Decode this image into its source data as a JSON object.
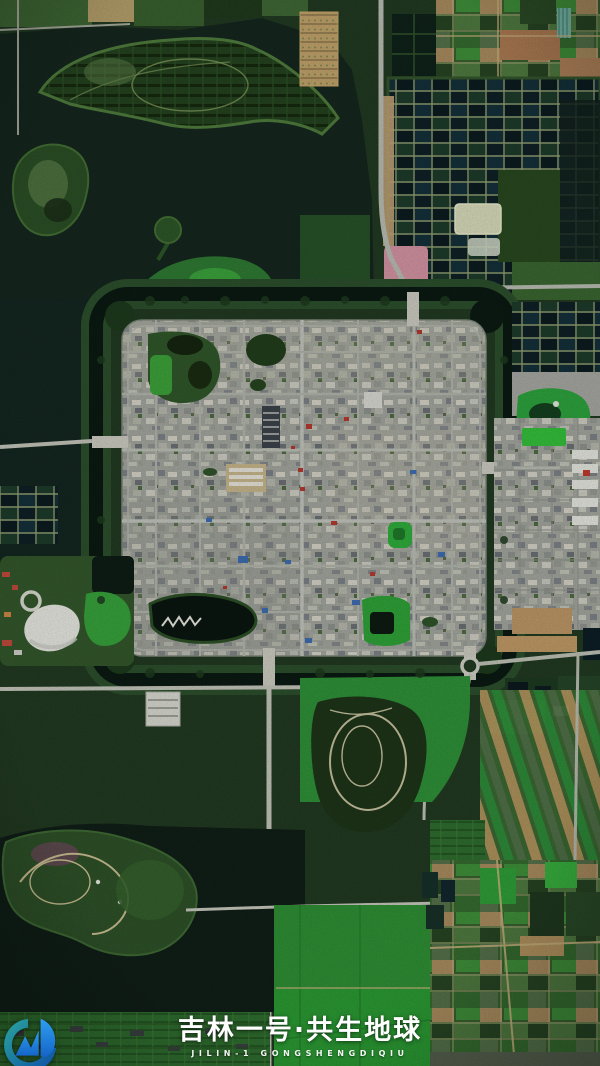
{
  "watermark": {
    "title_cn": "吉林一号·共生地球",
    "subtitle_en": "JILIN-1 GONGSHENGDIQIU",
    "text_color": "#ffffff",
    "logo_name": "jilin-1-globe-logo",
    "logo_blue_light": "#2e9ef0",
    "logo_blue_mid": "#1565c8",
    "logo_blue_dark": "#0d4ea8",
    "logo_teal": "#2aa49b"
  },
  "palette": {
    "vegetation_dark": "#223a22",
    "lake": "#15271e",
    "lake_deep": "#101e17",
    "moat_water": "#0b1a12",
    "moat_bank": "#2c4f2c",
    "vegetation_mid": "#2f5c2a",
    "vegetation_bright": "#2fae38",
    "field_tan": "#b3935f",
    "field_brown": "#ab7a52",
    "field_pink": "#d494a2",
    "urban_gray": "#a3a69e",
    "road_light": "#c3c5ba",
    "pond_pale": "#d8dbba",
    "roof_red": "#b5392f",
    "roof_blue": "#3e6db2",
    "dome_white": "#e8e8e2"
  }
}
